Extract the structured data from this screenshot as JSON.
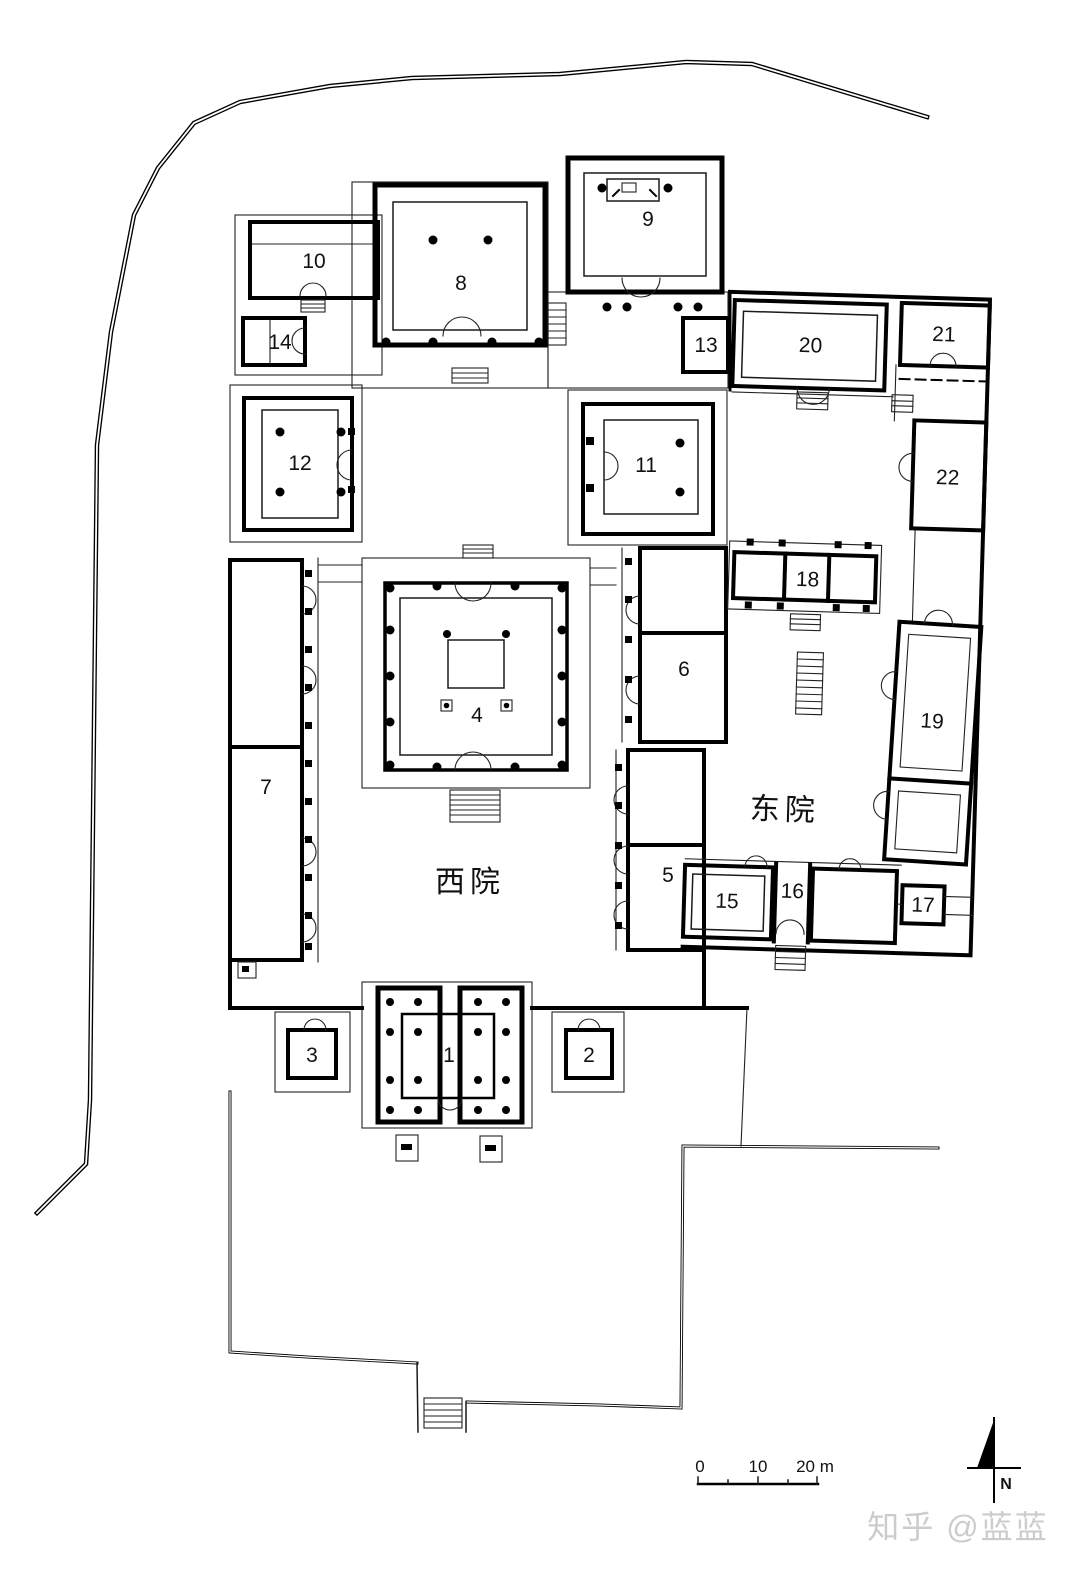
{
  "plan": {
    "rooms": {
      "n1": "1",
      "n2": "2",
      "n3": "3",
      "n4": "4",
      "n5": "5",
      "n6": "6",
      "n7": "7",
      "n8": "8",
      "n9": "9",
      "n10": "10",
      "n11": "11",
      "n12": "12",
      "n13": "13",
      "n14": "14",
      "n15": "15",
      "n16": "16",
      "n17": "17",
      "n18": "18",
      "n19": "19",
      "n20": "20",
      "n21": "21",
      "n22": "22"
    },
    "courtyards": {
      "west": "西院",
      "east": "东院"
    },
    "scale_bar": {
      "zero": "0",
      "ten": "10",
      "twenty": "20 m"
    },
    "compass": {
      "north": "N"
    },
    "watermark": "知乎 @蓝蓝"
  }
}
